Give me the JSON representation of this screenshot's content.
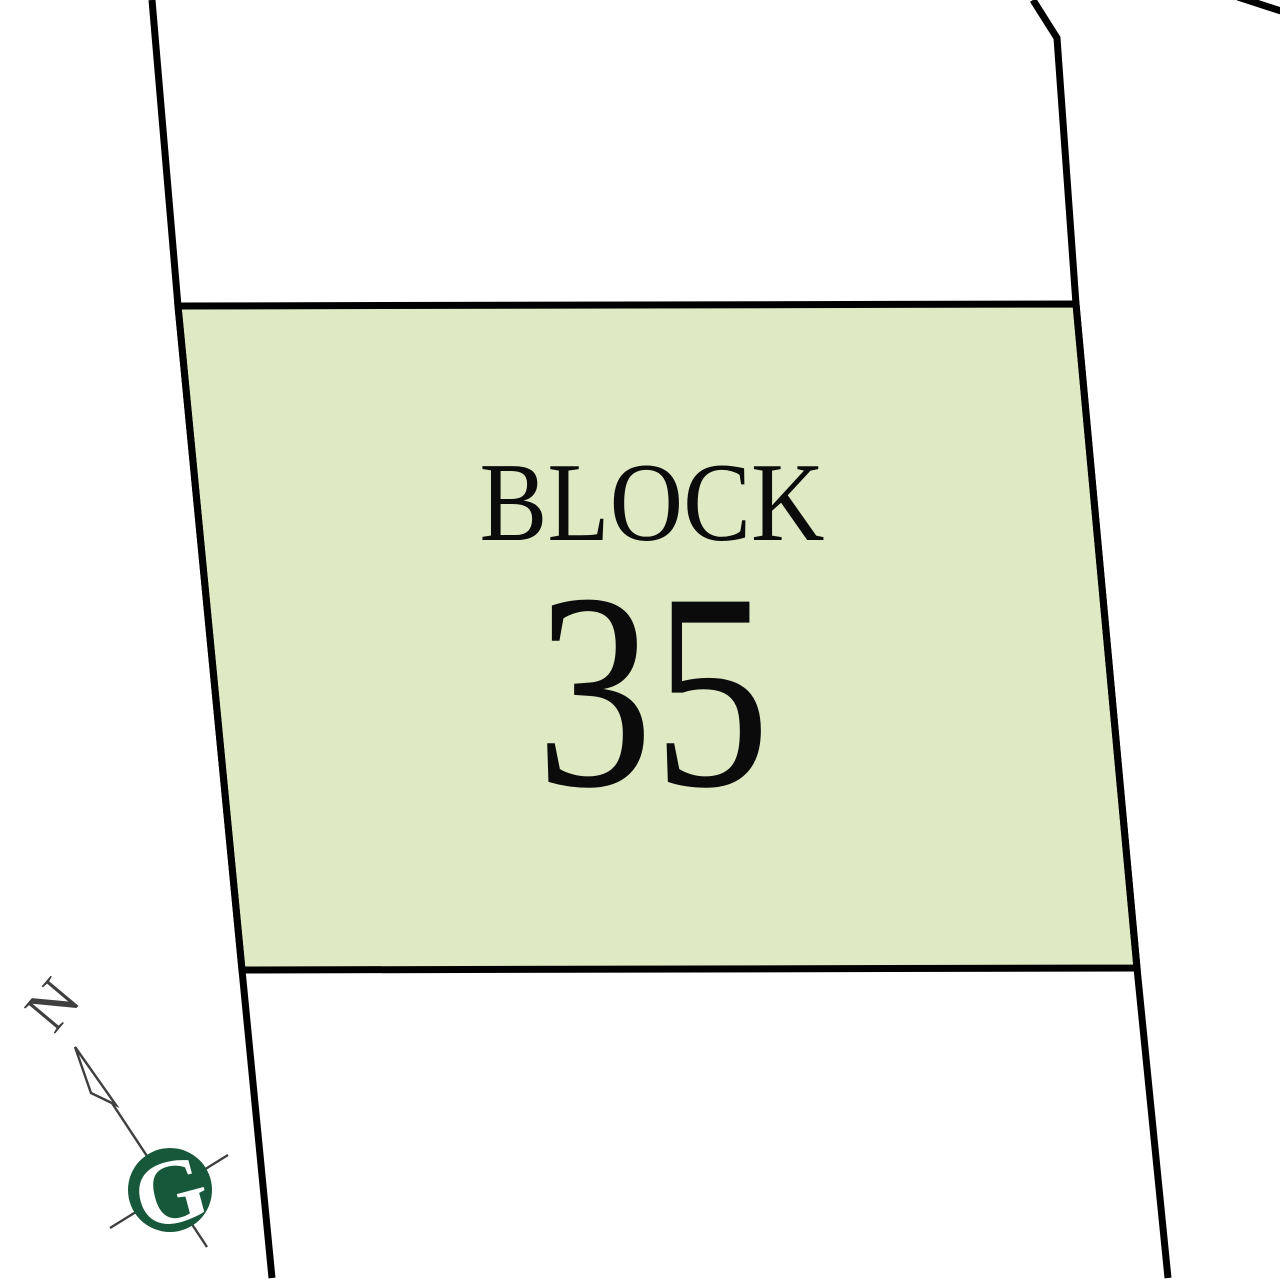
{
  "page": {
    "background_color": "#ffffff"
  },
  "parcel": {
    "label": "BLOCK",
    "number": "35",
    "fill_color": "#dfeac4",
    "boundary_color": "#000000"
  },
  "compass": {
    "north_label": "N",
    "logo_letter": "G",
    "line_color": "#3f3f3f",
    "logo_color": "#17583a",
    "logo_letter_color": "#ffffff"
  }
}
